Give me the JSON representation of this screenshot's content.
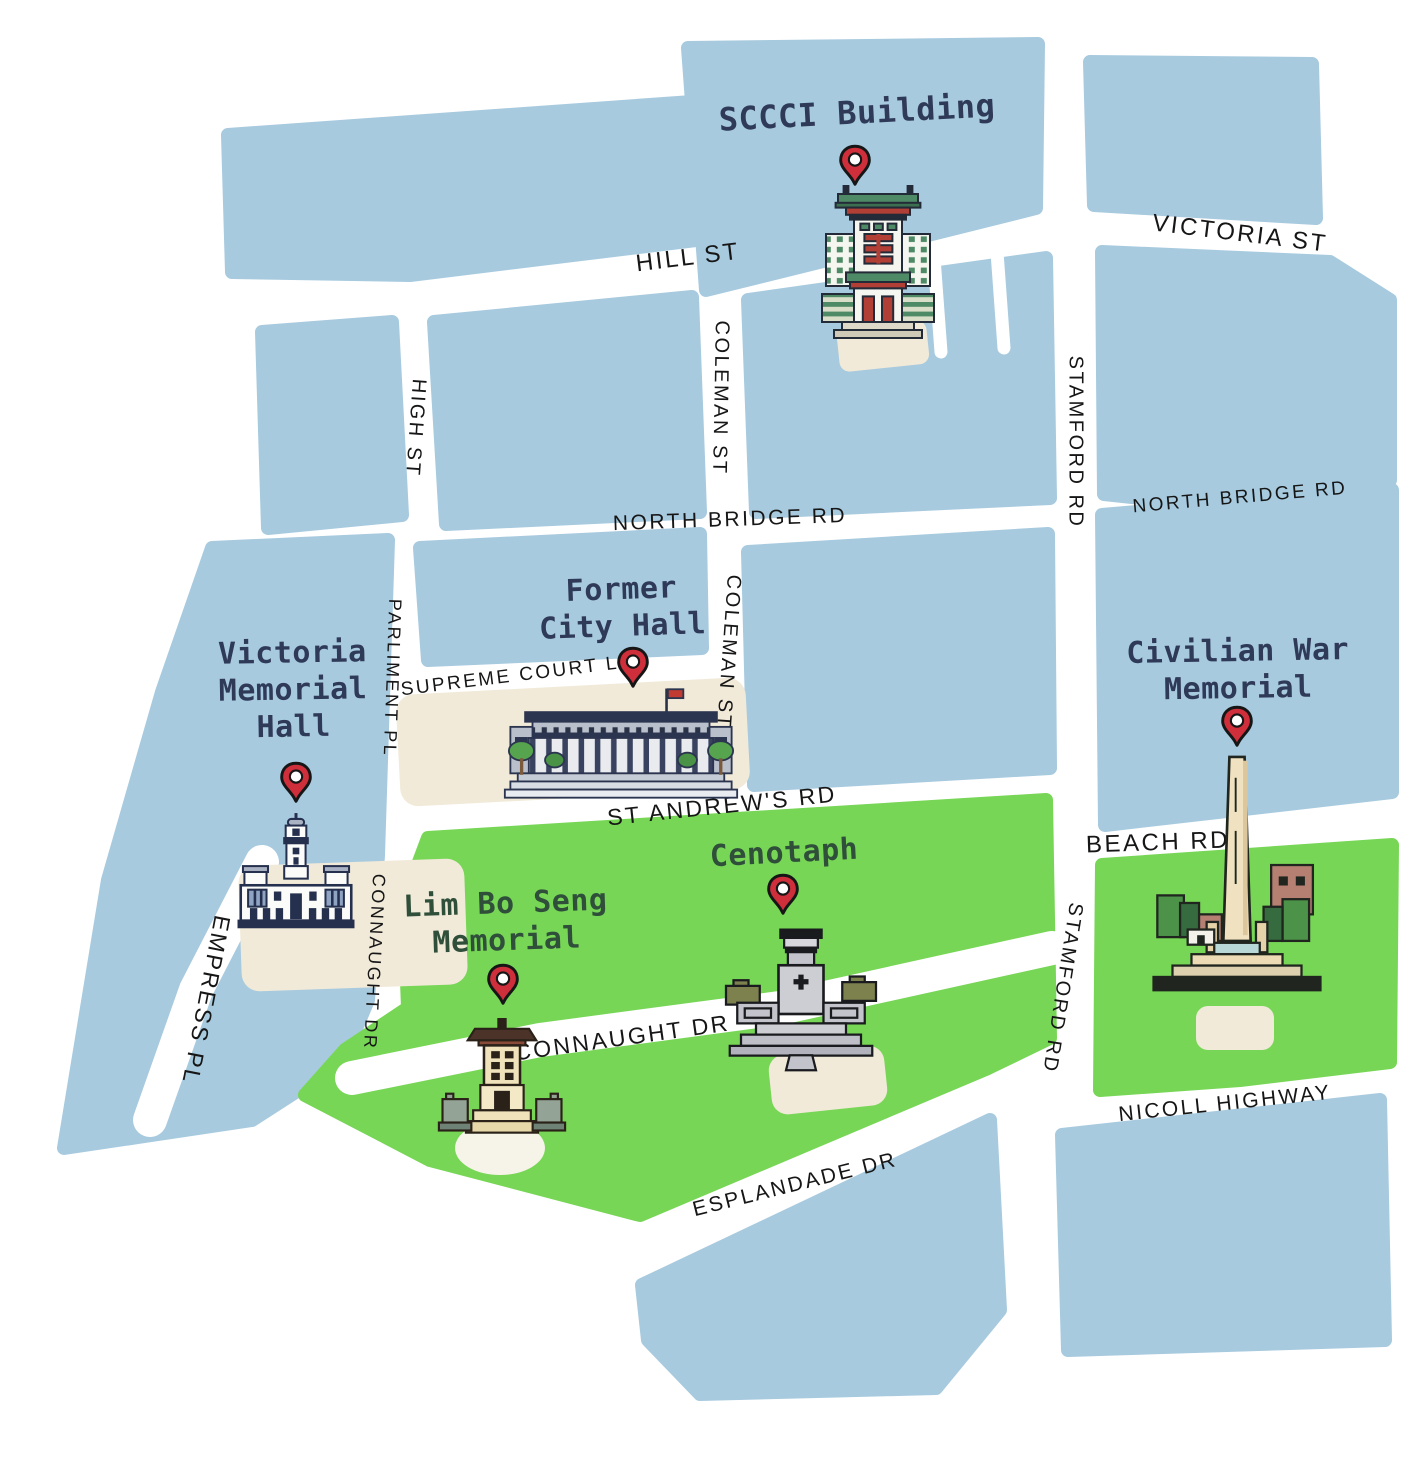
{
  "map_title": "Singapore Civic District landmarks map",
  "colors": {
    "block_blue": "#a7cadf",
    "park_green": "#77d656",
    "plaza_beige": "#f1ead9",
    "road_white": "#ffffff",
    "pin_red": "#ce2f3b",
    "poi_label_navy": "#2f3a58",
    "poi_label_green": "#2f4f3a",
    "road_label_color": "#161616"
  },
  "pois": [
    {
      "name": "SCCCI Building",
      "lines": [
        "SCCCI Building"
      ]
    },
    {
      "name": "Former City Hall",
      "lines": [
        "Former",
        "City Hall"
      ]
    },
    {
      "name": "Victoria Memorial Hall",
      "lines": [
        "Victoria",
        "Memorial",
        "Hall"
      ]
    },
    {
      "name": "Civilian War Memorial",
      "lines": [
        "Civilian War",
        "Memorial"
      ]
    },
    {
      "name": "Cenotaph",
      "lines": [
        "Cenotaph"
      ]
    },
    {
      "name": "Lim Bo Seng Memorial",
      "lines": [
        "Lim Bo Seng",
        "Memorial"
      ]
    }
  ],
  "roads": {
    "hill_st": "HILL ST",
    "victoria_st": "VICTORIA ST",
    "coleman_st": "COLEMAN ST",
    "high_st": "HIGH ST",
    "north_bridge_rd": "NORTH BRIDGE RD",
    "stamford_rd": "STAMFORD RD",
    "parliment_pl": "PARLIMENT PL",
    "supreme_court_ln": "SUPREME COURT LN",
    "st_andrews_rd": "ST ANDREW'S RD",
    "empress_pl": "EMPRESS PL",
    "connaught_dr": "CONNAUGHT DR",
    "beach_rd": "BEACH RD",
    "nicoll_highway": "NICOLL HIGHWAY",
    "esplandade_dr": "ESPLANDADE DR"
  }
}
